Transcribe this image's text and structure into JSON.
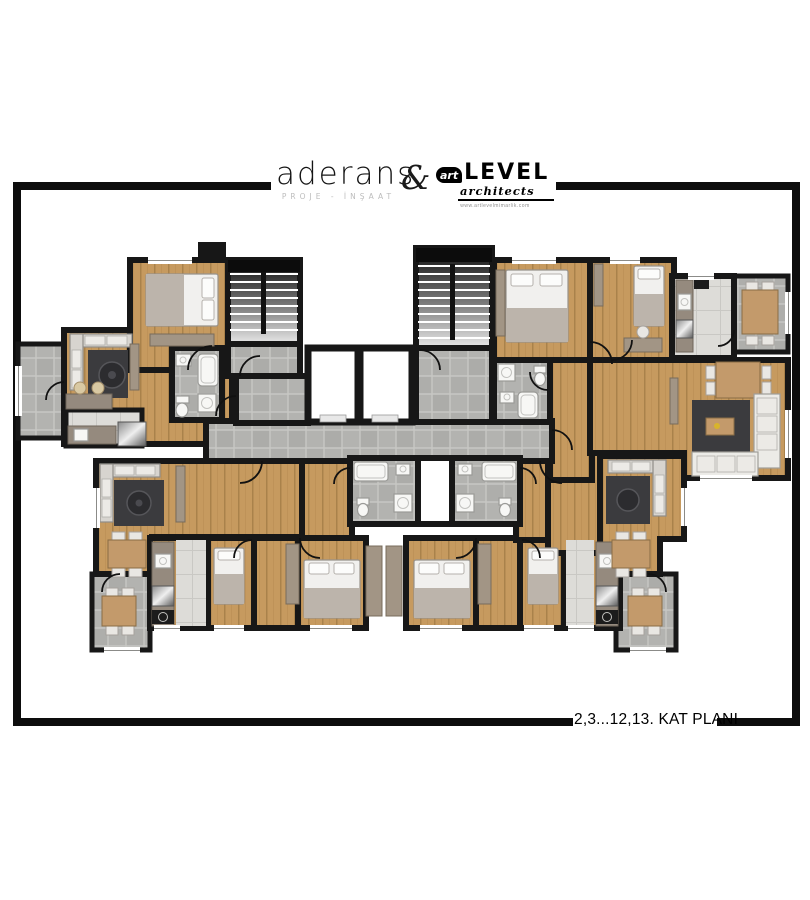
{
  "header": {
    "brand_left": {
      "name": "aderans",
      "subtitle": "PROJE - İNŞAAT"
    },
    "ampersand": "&",
    "brand_right": {
      "prefix": "art",
      "name": "LEVEL",
      "subtitle": "architects",
      "url": "www.artlevelmimarlik.com"
    }
  },
  "footer": {
    "plan_label": "2,3...12,13. KAT PLANI"
  },
  "palette": {
    "walls": "#171717",
    "wood_floor": "#c69a5f",
    "tile_floor": "#b3b3b0",
    "marble_floor": "#dddcd8",
    "rug": "#3b3b3e",
    "sofa": "#d7d4cf",
    "bed": "#f1f0ee",
    "counter": "#958a7e",
    "frame": "#0d0d0d"
  },
  "floor_plan": {
    "type": "architectural-floor-plan",
    "floors_shown": "2,3...12,13",
    "features": {
      "staircases": 2,
      "elevators": 2,
      "balconies": 4,
      "double_beds": 4,
      "single_beds": 4,
      "corner_sofas": 4,
      "dining_tables": 3,
      "bathrooms": 4,
      "kitchens": 4
    }
  }
}
